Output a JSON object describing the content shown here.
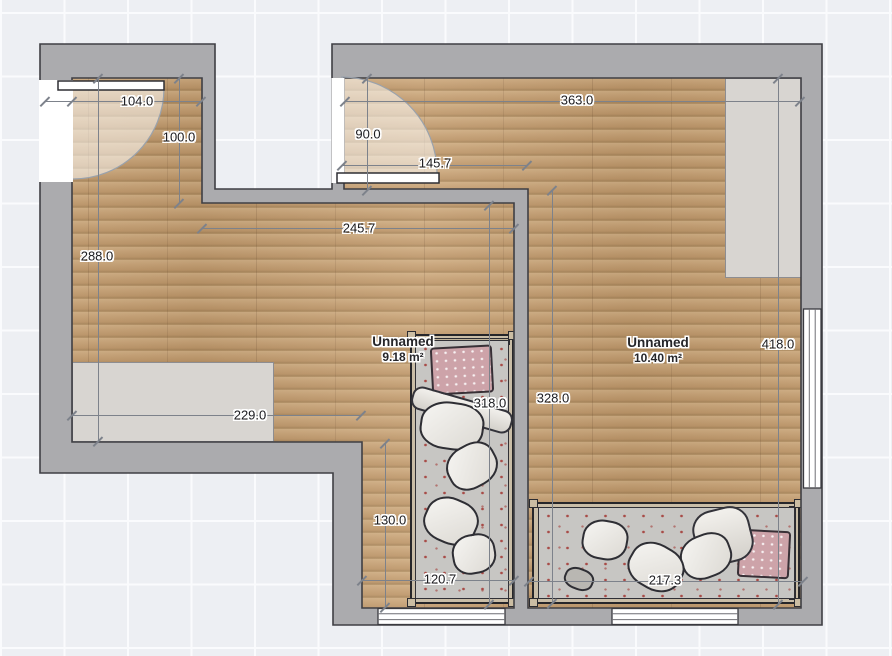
{
  "app": {
    "name": "floor-plan-editor",
    "view": "plan-canvas"
  },
  "rooms": [
    {
      "name": "Unnamed",
      "area": "9.18 m²"
    },
    {
      "name": "Unnamed",
      "area": "10.40 m²"
    }
  ],
  "dimensions": [
    {
      "label": "104.0",
      "orientation": "horizontal",
      "x1": 45,
      "y1": 101,
      "x2": 201,
      "y2": 101,
      "label_x": 137,
      "label_y": 101,
      "extra_ticks": [
        72
      ]
    },
    {
      "label": "100.0",
      "orientation": "vertical",
      "x1": 179,
      "y1": 78,
      "x2": 179,
      "y2": 203,
      "label_x": 179,
      "label_y": 137,
      "extra_ticks": []
    },
    {
      "label": "288.0",
      "orientation": "vertical",
      "x1": 98,
      "y1": 78,
      "x2": 98,
      "y2": 441,
      "label_x": 97,
      "label_y": 256,
      "extra_ticks": []
    },
    {
      "label": "363.0",
      "orientation": "horizontal",
      "x1": 345,
      "y1": 101,
      "x2": 800,
      "y2": 101,
      "label_x": 577,
      "label_y": 100,
      "extra_ticks": []
    },
    {
      "label": "90.0",
      "orientation": "vertical",
      "x1": 367,
      "y1": 78,
      "x2": 367,
      "y2": 190,
      "label_x": 368,
      "label_y": 134,
      "extra_ticks": []
    },
    {
      "label": "145.7",
      "orientation": "horizontal",
      "x1": 342,
      "y1": 165,
      "x2": 527,
      "y2": 165,
      "label_x": 435,
      "label_y": 163,
      "extra_ticks": []
    },
    {
      "label": "245.7",
      "orientation": "horizontal",
      "x1": 202,
      "y1": 228,
      "x2": 514,
      "y2": 228,
      "label_x": 359,
      "label_y": 228,
      "extra_ticks": []
    },
    {
      "label": "229.0",
      "orientation": "horizontal",
      "x1": 72,
      "y1": 415,
      "x2": 361,
      "y2": 415,
      "label_x": 250,
      "label_y": 415,
      "extra_ticks": []
    },
    {
      "label": "318.0",
      "orientation": "vertical",
      "x1": 489,
      "y1": 205,
      "x2": 489,
      "y2": 604,
      "label_x": 490,
      "label_y": 403,
      "extra_ticks": []
    },
    {
      "label": "328.0",
      "orientation": "vertical",
      "x1": 552,
      "y1": 190,
      "x2": 552,
      "y2": 603,
      "label_x": 553,
      "label_y": 398,
      "extra_ticks": []
    },
    {
      "label": "418.0",
      "orientation": "vertical",
      "x1": 778,
      "y1": 78,
      "x2": 778,
      "y2": 604,
      "label_x": 778,
      "label_y": 344,
      "extra_ticks": []
    },
    {
      "label": "130.0",
      "orientation": "vertical",
      "x1": 385,
      "y1": 443,
      "x2": 385,
      "y2": 607,
      "label_x": 390,
      "label_y": 520,
      "extra_ticks": []
    },
    {
      "label": "120.7",
      "orientation": "horizontal",
      "x1": 362,
      "y1": 580,
      "x2": 514,
      "y2": 580,
      "label_x": 440,
      "label_y": 579,
      "extra_ticks": []
    },
    {
      "label": "217.3",
      "orientation": "horizontal",
      "x1": 529,
      "y1": 581,
      "x2": 803,
      "y2": 581,
      "label_x": 665,
      "label_y": 580,
      "extra_ticks": []
    }
  ],
  "objects": {
    "beds": [
      "single-bed-room1",
      "single-bed-room2"
    ],
    "storage": [
      "low-cabinet-room1",
      "wardrobe-room2"
    ],
    "doors": [
      "entry-door-room1",
      "entry-door-room2"
    ],
    "windows": [
      "window-room1-south",
      "window-room2-south",
      "window-room2-east"
    ]
  },
  "colors": {
    "background": "#edeff3",
    "grid_line": "#fafbfd",
    "wall_fill": "#ababae",
    "wall_outline": "#3f3f44",
    "floor_wood": "#c4a076",
    "furniture_fill": "#d8d5d1",
    "dimension_line": "#7d828b",
    "label_text": "#1c1c20",
    "pillow_pink": "#cda3a9",
    "duvet_gray": "#c7c6c3"
  }
}
